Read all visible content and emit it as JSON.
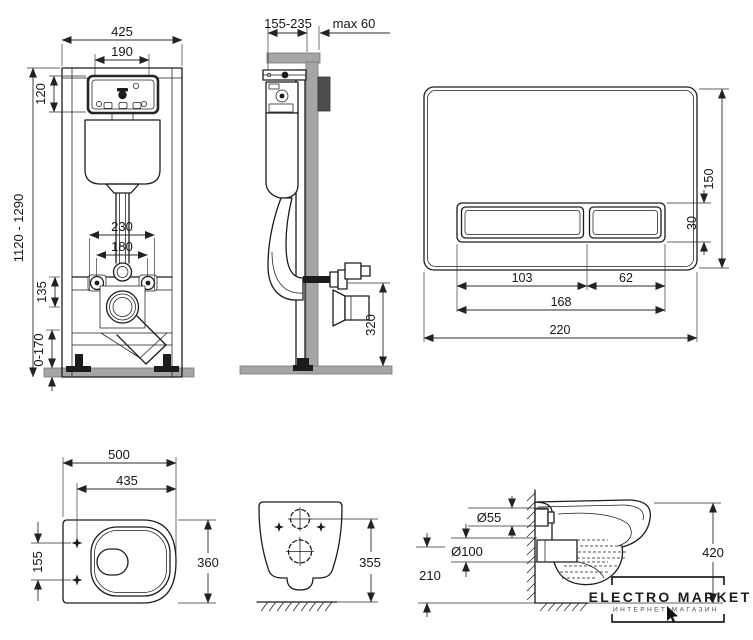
{
  "colors": {
    "background": "#ffffff",
    "line": "#1c1c1c",
    "wall_fill": "#a5a5a5",
    "bracket_fill": "#4e4e4e",
    "text": "#161616"
  },
  "views": {
    "frame_front": {
      "dims": {
        "total_width": "425",
        "inner_width": "190",
        "panel_height": "120",
        "frame_height": "1120 - 1290",
        "fixing_width_outer": "230",
        "fixing_width_inner": "180",
        "outlet_drop": "135",
        "foot_range": "0-170"
      }
    },
    "frame_side": {
      "dims": {
        "depth": "155-235",
        "wall_max": "max 60",
        "outlet_height": "320"
      }
    },
    "flush_plate": {
      "dims": {
        "width": "220",
        "height": "150",
        "button_height": "30",
        "large_button_width": "103",
        "small_button_width": "62",
        "buttons_width": "168"
      }
    },
    "bowl_top": {
      "dims": {
        "length": "500",
        "inner_length": "435",
        "hole_spacing": "155",
        "width": "360"
      }
    },
    "bowl_back": {
      "dims": {
        "hole_height": "355"
      }
    },
    "bowl_side": {
      "dims": {
        "inlet_diameter": "Ø55",
        "outlet_diameter": "Ø100",
        "outlet_axis_height": "210",
        "bowl_height": "420"
      }
    }
  },
  "logo": {
    "title": "ELECTRO MARKET",
    "subtitle": "ИНТЕРНЕТ-МАГАЗИН"
  }
}
